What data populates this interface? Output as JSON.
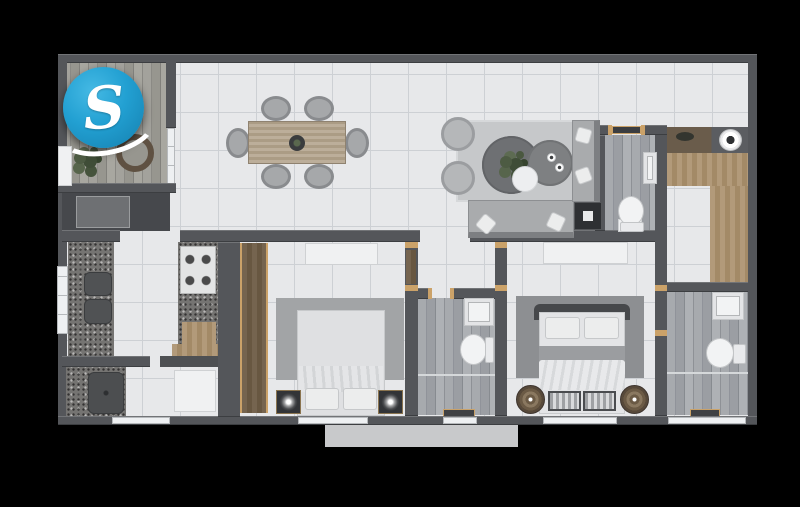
{
  "scene": {
    "type": "3d-floor-plan-render",
    "description": "Top-down 3D rendered apartment floor plan on black background",
    "logo": {
      "letter": "S",
      "circle_color": "#22a0d2",
      "letter_color": "#ffffff"
    },
    "palette": {
      "background": "#000000",
      "wall_grey": "#54565a",
      "tile_floor": "#e7e8ea",
      "tile_grout": "#cdd0d4",
      "plank_floor_grey": "#9b9ea3",
      "balcony_wood": "#97968f",
      "counter_granite": "#757472",
      "wood_light": "#ab9272",
      "wood_dark": "#6e5d48",
      "sofa_grey": "#a9abad",
      "rug_light": "#c6c8ca",
      "rug_mid": "#a2a4a6",
      "rug_dark": "#8d8f92",
      "bed1_duvet_brown": "#7b6c5f",
      "bed2_duvet_white": "#e5e6e8",
      "fixture_white": "#f0f1f2",
      "plant_green": "#4d5b43",
      "door_frame_gold": "#cba269",
      "exterior_slab": "#c8c9cb"
    },
    "rooms": [
      {
        "name": "balcony-terrace"
      },
      {
        "name": "dining-area"
      },
      {
        "name": "living-area"
      },
      {
        "name": "kitchen"
      },
      {
        "name": "laundry-area"
      },
      {
        "name": "hallway"
      },
      {
        "name": "bedroom-1"
      },
      {
        "name": "bathroom-1"
      },
      {
        "name": "master-bedroom"
      },
      {
        "name": "master-bathroom"
      },
      {
        "name": "powder-bathroom"
      },
      {
        "name": "utility-room"
      }
    ]
  }
}
